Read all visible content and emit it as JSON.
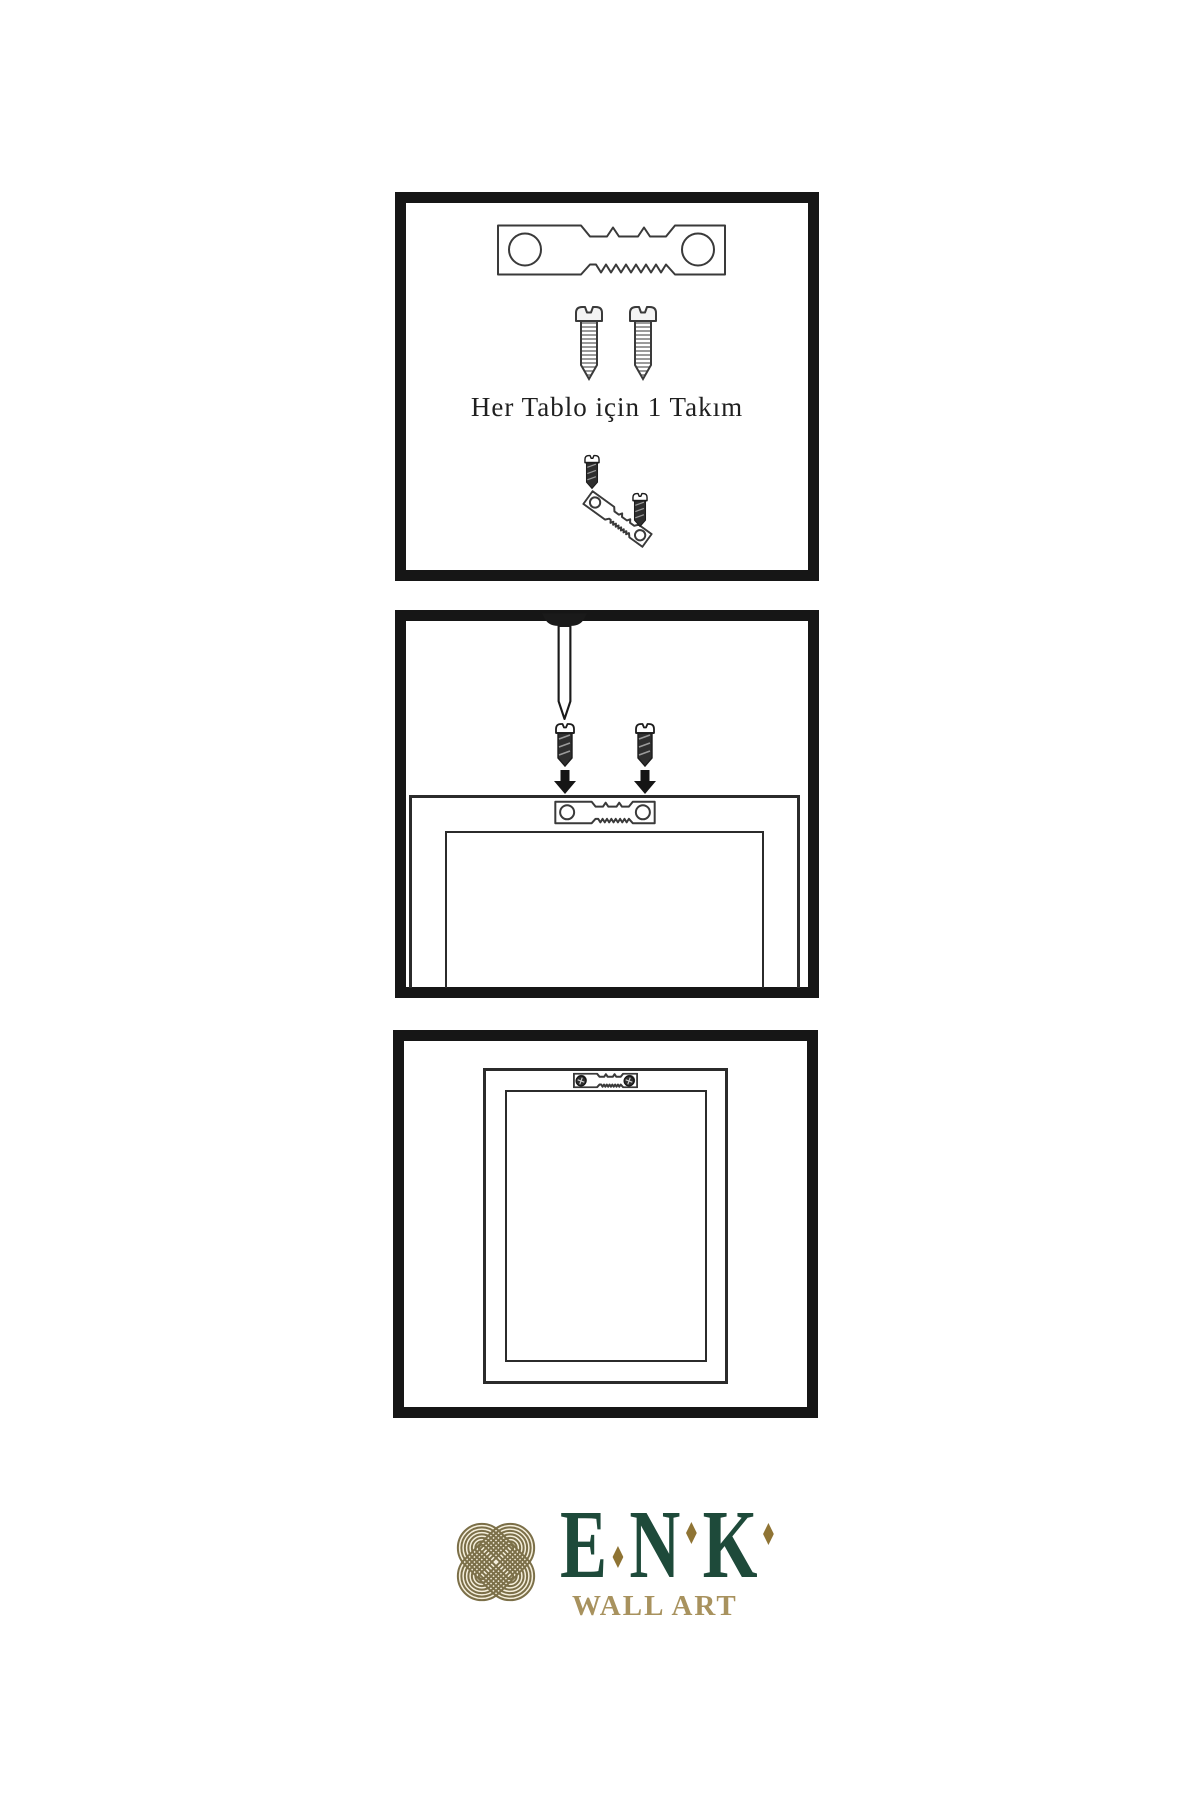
{
  "document": {
    "type": "wall-art-hanging-instructions",
    "background": "#ffffff"
  },
  "panel1": {
    "caption": "Her Tablo için 1 Takım",
    "contents": [
      "sawtooth-hanger",
      "screw",
      "screw",
      "small-screw",
      "tilted-sawtooth-hanger",
      "small-screw"
    ]
  },
  "panel2": {
    "contents": [
      "wall-nail",
      "screw",
      "screw",
      "down-arrow",
      "down-arrow",
      "frame-back",
      "sawtooth-hanger-small"
    ]
  },
  "panel3": {
    "contents": [
      "frame-back",
      "installed-sawtooth-hanger",
      "screw-head",
      "screw-head"
    ]
  },
  "logo": {
    "brand": "ENK",
    "letters": [
      "E",
      "N",
      "K"
    ],
    "tagline": "WALL ART",
    "colors": {
      "brand_green": "#1e4a3a",
      "brand_gold": "#a8925e",
      "diamond_gold": "#8f7434",
      "emblem_olive": "#7b6f48",
      "emblem_cream": "#f5efdc"
    }
  },
  "colors": {
    "panel_border": "#161616",
    "line_art": "#3a3a3a"
  }
}
